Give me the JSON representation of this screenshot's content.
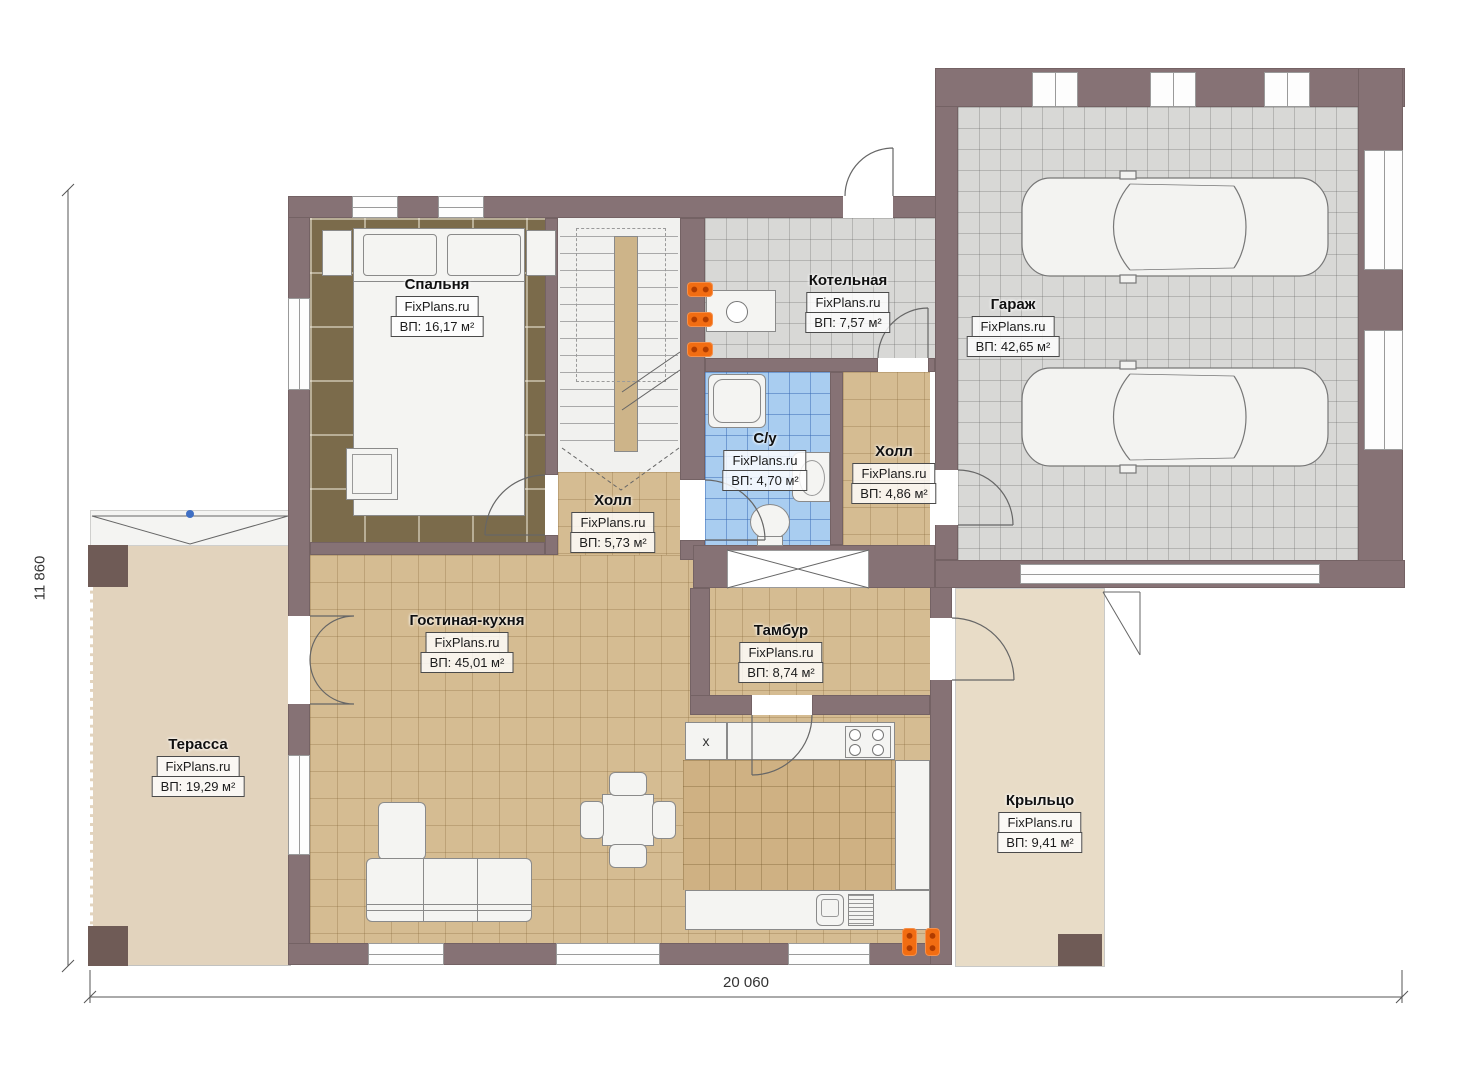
{
  "watermark": "FixPlans.ru",
  "dimensions": {
    "width": "20 060",
    "height": "11 860"
  },
  "rooms": [
    {
      "name": "Спальня",
      "area": "ВП: 16,17 м²"
    },
    {
      "name": "Котельная",
      "area": "ВП: 7,57 м²"
    },
    {
      "name": "Гараж",
      "area": "ВП: 42,65 м²"
    },
    {
      "name": "С/у",
      "area": "ВП: 4,70 м²"
    },
    {
      "name": "Холл",
      "area": "ВП: 4,86 м²"
    },
    {
      "name": "Холл",
      "area": "ВП: 5,73 м²"
    },
    {
      "name": "Гостиная-кухня",
      "area": "ВП: 45,01 м²"
    },
    {
      "name": "Тамбур",
      "area": "ВП: 8,74 м²"
    },
    {
      "name": "Терасса",
      "area": "ВП: 19,29 м²"
    },
    {
      "name": "Крыльцо",
      "area": "ВП: 9,41 м²"
    }
  ],
  "marks": {
    "kitchen_island": "x"
  },
  "colors": {
    "wall": "#867275",
    "post": "#6f5b56",
    "floor_tan": "#d5bc92",
    "floor_kitchen": "#cfb183",
    "floor_gray": "#d8d8d6",
    "floor_blue": "#a9cdf0",
    "floor_bedroom": "#7b6b4b",
    "terrace": "#e2d3bd",
    "porch": "#e8dcc7",
    "radiator": "#f26d12",
    "roof_marker_blue": "#3f6fc4"
  }
}
